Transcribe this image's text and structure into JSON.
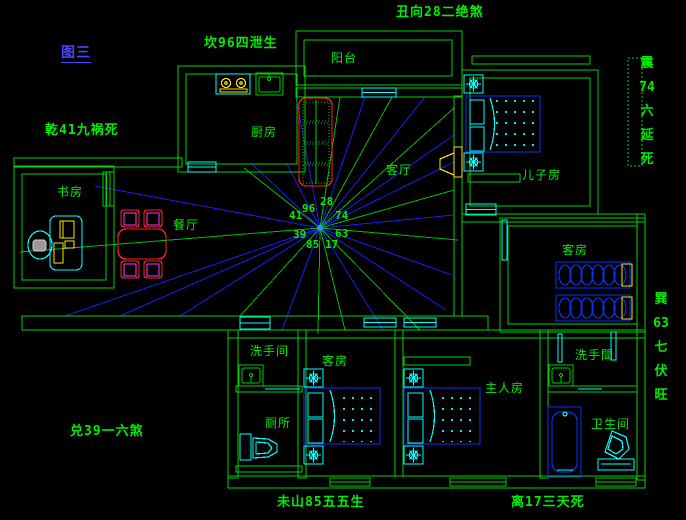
{
  "title": "图三",
  "compass_labels": {
    "kan": "坎96四泄生",
    "chou": "丑向28二绝煞",
    "qian": "乾41九祸死",
    "zhen": "震74六延死",
    "xun": "巽63七伏旺",
    "dui": "兑39一六煞",
    "weishan": "未山85五五生",
    "li": "离17三天死"
  },
  "rooms": {
    "balcony": "阳台",
    "kitchen": "厨房",
    "living_room": "客厅",
    "son_room": "儿子房",
    "study": "书房",
    "dining": "餐厅",
    "guest_room_east": "客房",
    "washroom_nw": "洗手间",
    "guest_room_south": "客房",
    "master_room": "主人房",
    "washroom_se": "洗手間",
    "toilet": "厕所",
    "bathroom": "卫生间"
  },
  "star_numbers": {
    "n96": "96",
    "n28": "28",
    "n74": "74",
    "n63": "63",
    "n17": "17",
    "n85": "85",
    "n39": "39",
    "n41": "41"
  },
  "colors": {
    "background": "#000000",
    "wall_green": "#00d400",
    "text_green": "#00ee00",
    "title_blue": "#4747ff",
    "ray_blue": "#1c1cf0",
    "ray_green": "#00bb00",
    "bed_blue": "#0a32ff",
    "fixture_cyan": "#00ffff",
    "furniture_red": "#ff2020",
    "chair_magenta": "#ff38ff",
    "appliance_yellow": "#ffe600"
  }
}
